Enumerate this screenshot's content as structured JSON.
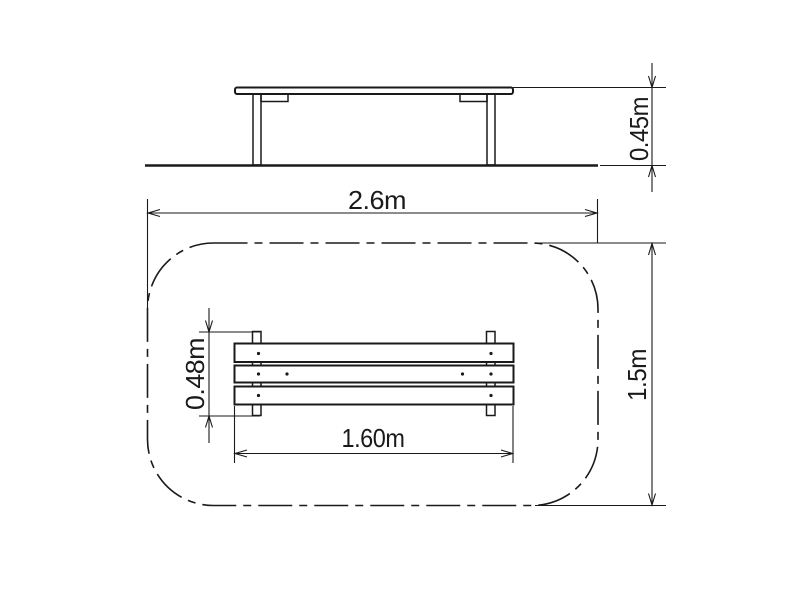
{
  "drawing": {
    "type": "technical-drawing",
    "subject": "park bench with safety zone, elevation and plan views"
  },
  "labels": {
    "bench_height": "0.45m",
    "safety_zone_width": "2.6m",
    "safety_zone_depth": "1.5m",
    "bench_depth": "0.48m",
    "bench_length": "1.60m"
  },
  "colors": {
    "line": "#1a1a1a",
    "background": "#ffffff"
  }
}
